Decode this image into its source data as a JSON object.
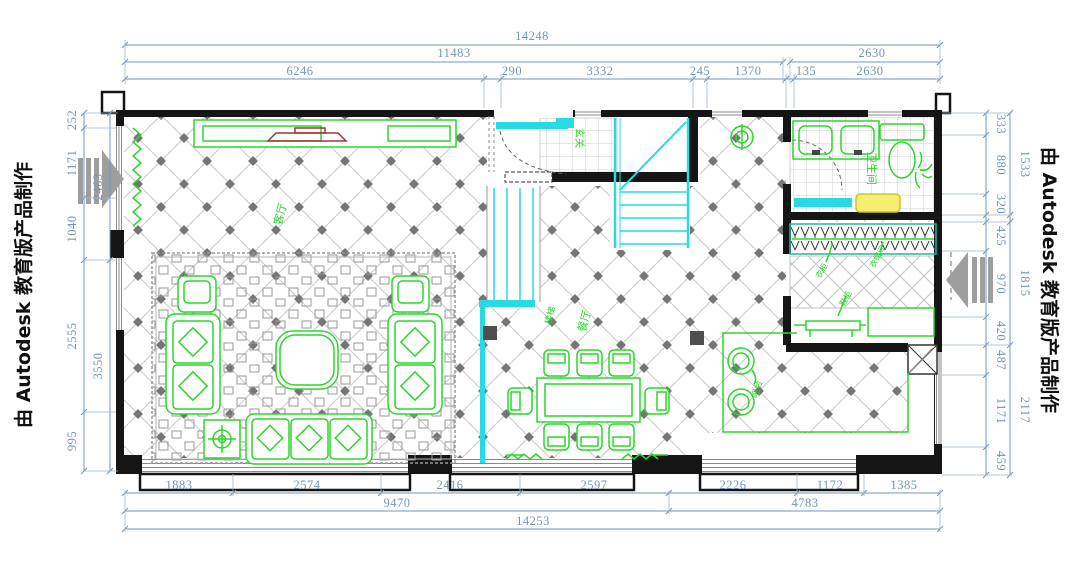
{
  "watermarks": {
    "left": "由 Autodesk 教育版产品制作",
    "right": "由 Autodesk 教育版产品制作"
  },
  "dims": {
    "top_total": "14248",
    "top_mid": "11483",
    "top_right": "2630",
    "top_row3": [
      "6246",
      "290",
      "3332",
      "245",
      "1370",
      "135",
      "2630"
    ],
    "bottom_row1": [
      "1883",
      "2574",
      "2416",
      "2597",
      "2226",
      "1172",
      "1385"
    ],
    "bottom_mid": [
      "9470",
      "4783"
    ],
    "bottom_total": "14253",
    "left_col": [
      "252",
      "1171",
      "1040",
      "2555",
      "995"
    ],
    "left_sum": [
      "2463",
      "3550"
    ],
    "right_col": [
      "333",
      "880",
      "320",
      "425",
      "970",
      "420",
      "487",
      "1171",
      "459"
    ],
    "right_sum": [
      "1533",
      "1815",
      "2117"
    ]
  },
  "room_labels": {
    "living": "客厅",
    "dining": "餐厅",
    "entry": "玄关",
    "stairs": "楼梯",
    "bathroom": "卫生间",
    "bar": "吧台",
    "closet_note_1": "衣柜",
    "closet_note_2": "衣帽间",
    "closet_note_3": "鞋柜"
  },
  "colors": {
    "dimension_text": "#7495b8",
    "furniture_green": "#2ed52e",
    "stair_door_cyan": "#2bd9e5",
    "wall_black": "#151515",
    "tv_red": "#a03636",
    "bath_mat_yellow": "#f5ee71",
    "section_arrow_gray": "#9e9e9e"
  }
}
